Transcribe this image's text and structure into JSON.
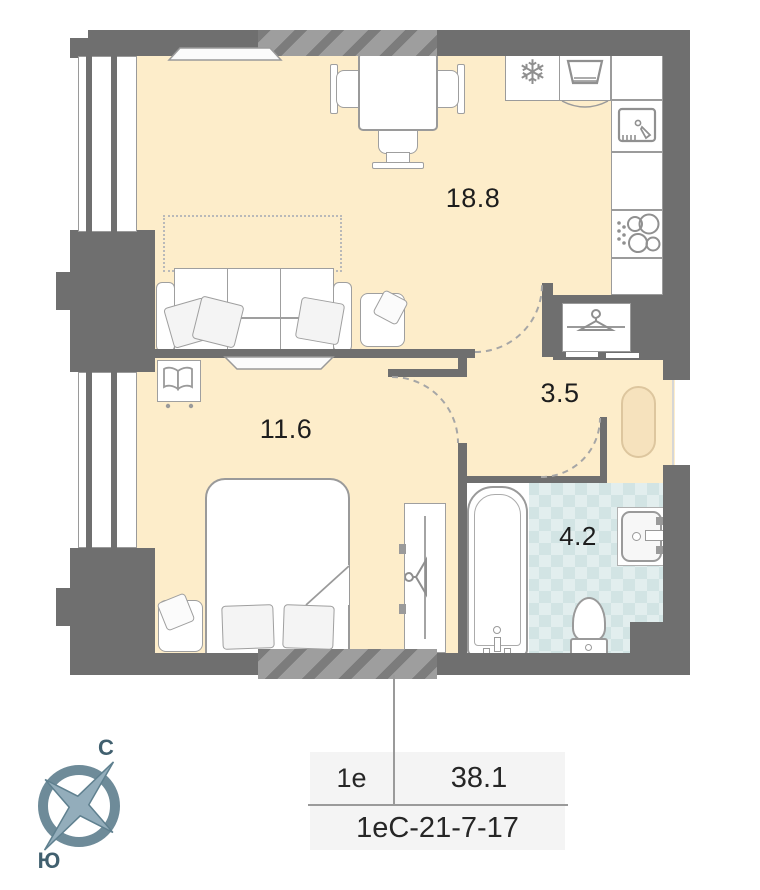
{
  "plan": {
    "rooms": [
      {
        "id": "living-kitchen",
        "area": "18.8"
      },
      {
        "id": "bedroom",
        "area": "11.6"
      },
      {
        "id": "hallway",
        "area": "3.5"
      },
      {
        "id": "bathroom",
        "area": "4.2"
      }
    ],
    "compass": {
      "north": "С",
      "south": "Ю"
    },
    "glyphs": {
      "snowflake": "❄"
    },
    "icons": [
      "fridge-snowflake-icon",
      "washing-machine-icon",
      "kitchen-sink-icon",
      "stove-burners-icon",
      "hanger-icon",
      "book-icon",
      "bathtub-icon",
      "toilet-icon",
      "washbasin-icon",
      "compass-rose-icon"
    ],
    "colors": {
      "floor": "#fdedca",
      "wall": "#6f6f6f",
      "tile_base": "#e2eeee",
      "tile_check": "#d2e4e4",
      "rug": "#f6e2bd",
      "compass": "#6e8b99"
    }
  },
  "info_table": {
    "flat_type": "1е",
    "total_area": "38.1",
    "flat_code": "1еС-21-7-17"
  }
}
